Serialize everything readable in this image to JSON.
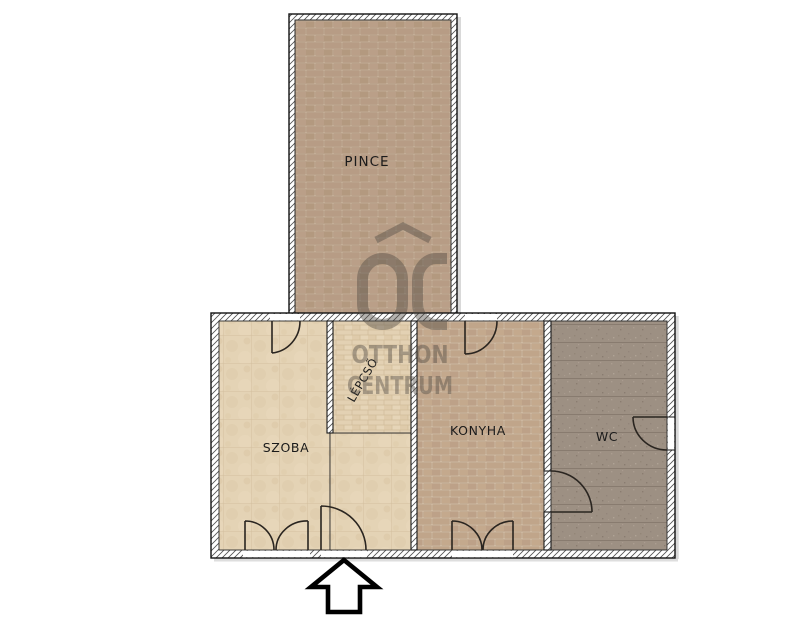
{
  "page": {
    "title": "Apartment floor plan",
    "background": "#ffffff"
  },
  "rooms": [
    {
      "id": "pince",
      "label": "PINCE"
    },
    {
      "id": "szoba",
      "label": "SZOBA"
    },
    {
      "id": "lepcso",
      "label": "LÉPCSŐ"
    },
    {
      "id": "konyha",
      "label": "KONYHA"
    },
    {
      "id": "wc",
      "label": "WC"
    }
  ],
  "watermark": {
    "mark": "OC",
    "line1": "OTTHON",
    "line2": "CENTRUM"
  },
  "icons": {
    "entrance_arrow": "up-arrow-outline",
    "door_swing": "quarter-arc"
  },
  "colors": {
    "pince_brick": "#b79c85",
    "pince_mortar": "#cdb8a2",
    "konyha_brick": "#c0a58a",
    "konyha_mortar": "#d8c4ad",
    "szoba_floor": "#e4d3b5",
    "stairs_floor": "#e1cfb0",
    "wc_floor": "#9d9083",
    "wall_fill": "#ffffff",
    "outline": "#1a1a1a",
    "watermark_gray": "#4f4942"
  }
}
